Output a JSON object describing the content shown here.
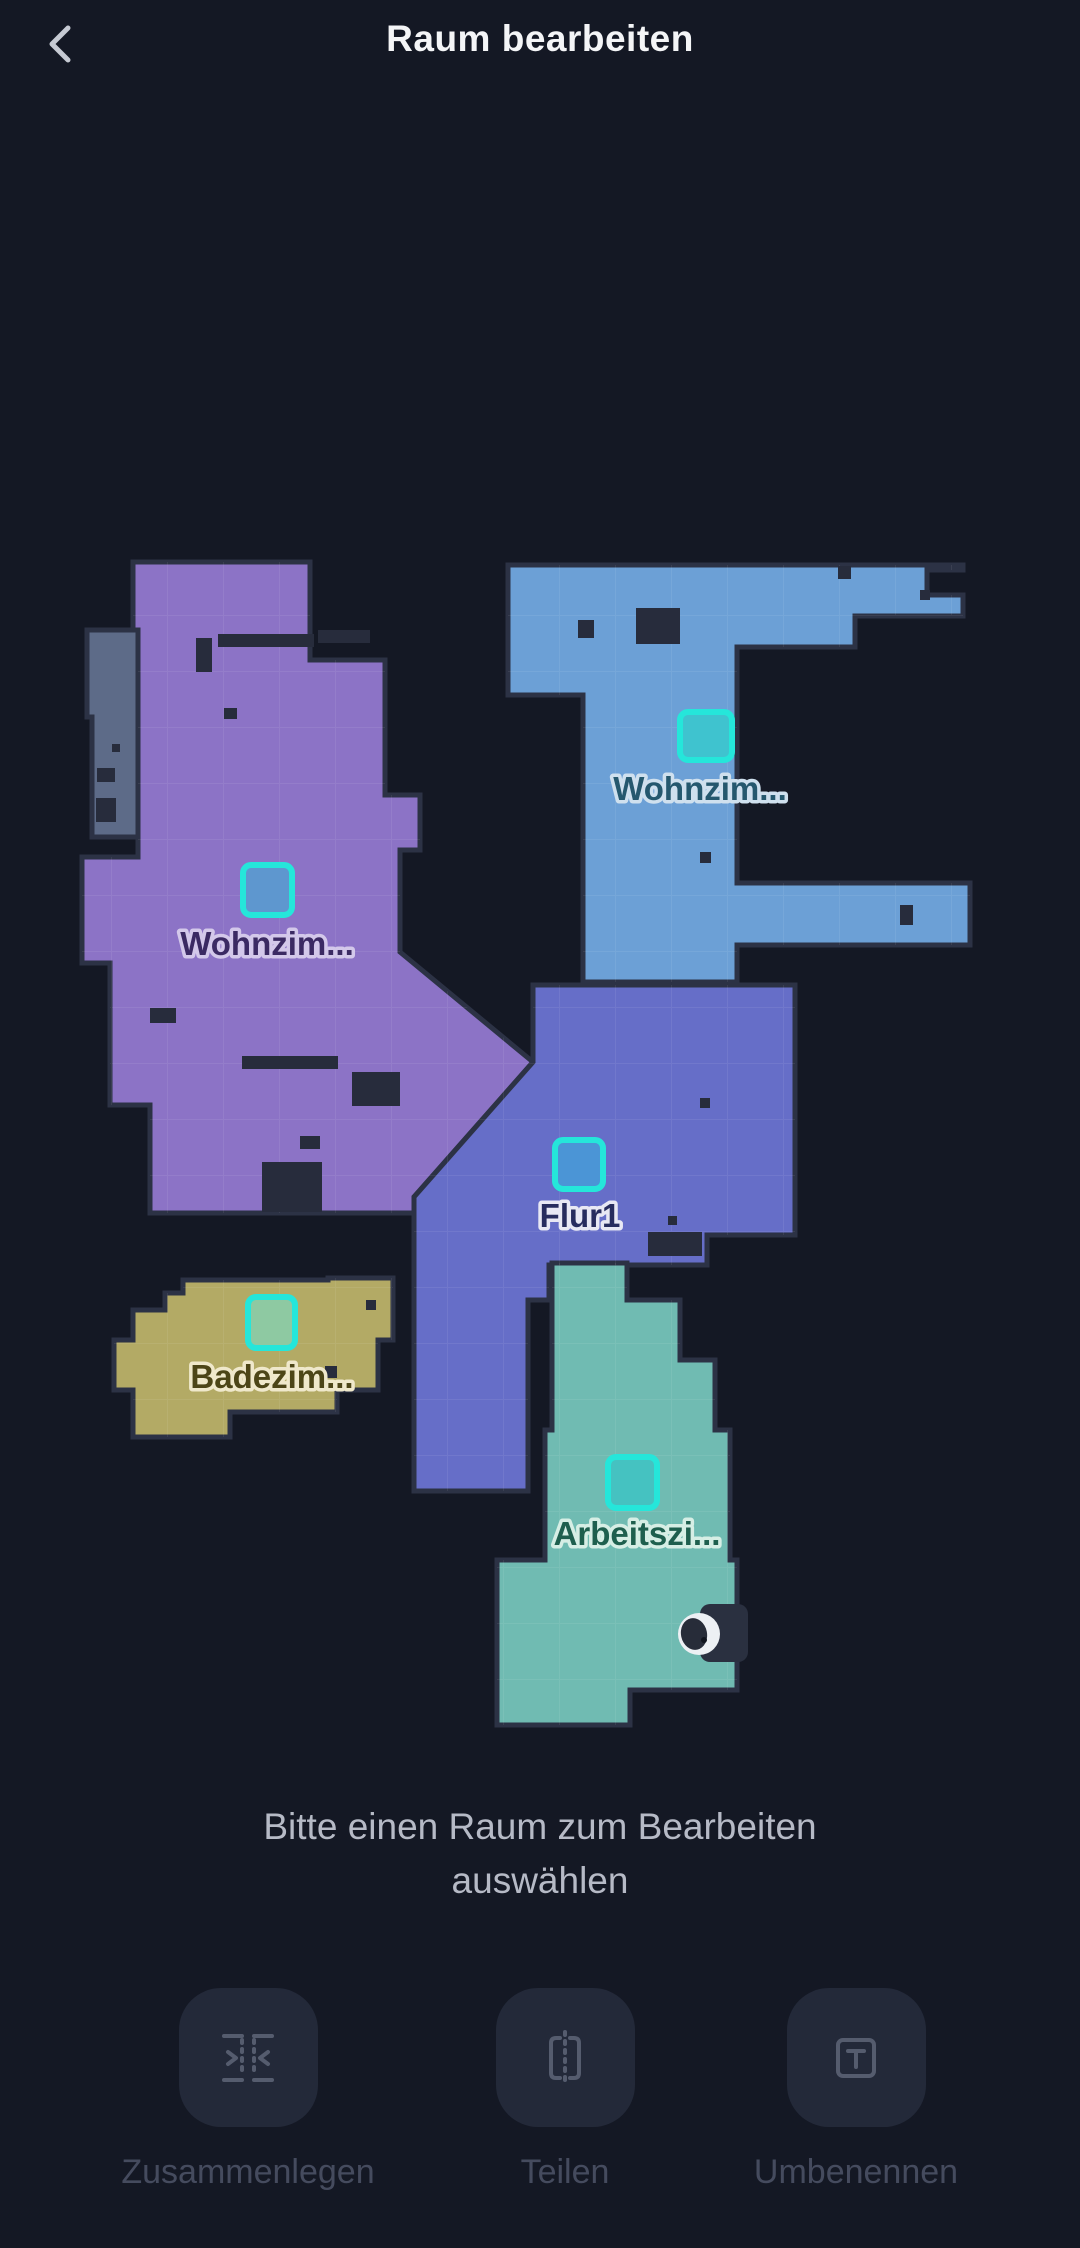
{
  "header": {
    "title": "Raum bearbeiten"
  },
  "map": {
    "marker_border": "#25e6da",
    "unassigned_color": "#5d6b88",
    "rooms": [
      {
        "id": "wohnzimmer-links",
        "label": "Wohnzim...",
        "color": "#8c73c6",
        "label_color": "#3b2a63",
        "halo": "#d3c8ea",
        "marker_fill": "#5e97cf"
      },
      {
        "id": "wohnzimmer-rechts",
        "label": "Wohnzim...",
        "color": "#6ca0d6",
        "label_color": "#25586e",
        "halo": "#cfe0ee",
        "marker_fill": "#3fc3cf"
      },
      {
        "id": "flur1",
        "label": "Flur1",
        "color": "#666ec8",
        "label_color": "#272c5e",
        "halo": "#e8e8f4",
        "marker_fill": "#4b95d6"
      },
      {
        "id": "badezimmer",
        "label": "Badezim...",
        "color": "#b3aa65",
        "label_color": "#4c4517",
        "halo": "#efe8cb",
        "marker_fill": "#8ec9a2"
      },
      {
        "id": "arbeitszimmer",
        "label": "Arbeitszi...",
        "color": "#70bbb2",
        "label_color": "#1e5f4e",
        "halo": "#d6eee5",
        "marker_fill": "#45c2c1"
      }
    ]
  },
  "hint": {
    "line1": "Bitte einen Raum zum Bearbeiten",
    "line2": "auswählen"
  },
  "actions": [
    {
      "id": "merge",
      "label": "Zusammenlegen"
    },
    {
      "id": "split",
      "label": "Teilen"
    },
    {
      "id": "rename",
      "label": "Umbenennen"
    }
  ]
}
